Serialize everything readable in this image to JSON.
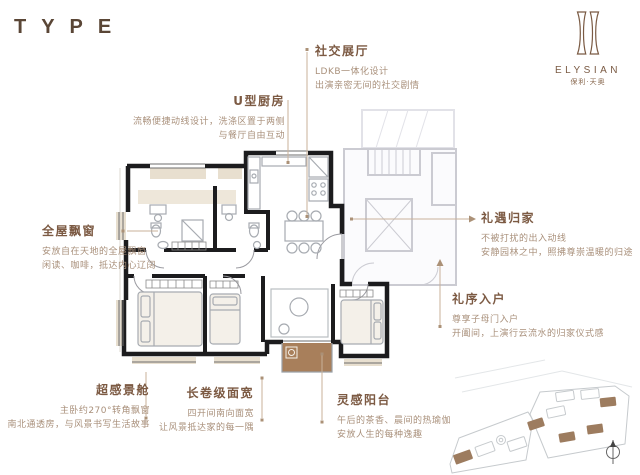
{
  "header": {
    "type_label": "TYPE"
  },
  "brand": {
    "name": "ELYSIAN",
    "cn_name": "保利·天奥"
  },
  "annotations": {
    "social_hall": {
      "title": "社交展厅",
      "lines": [
        "LDKB一体化设计",
        "出演亲密无间的社交剧情"
      ]
    },
    "u_kitchen": {
      "title": "U型厨房",
      "lines": [
        "流畅便捷动线设计，洗涤区置于两侧",
        "与餐厅自由互动"
      ]
    },
    "bay_windows": {
      "title": "全屋飘窗",
      "lines": [
        "安放自在天地的全屋飘窗",
        "闲读、咖啡，抵达内心辽阔"
      ]
    },
    "homecoming": {
      "title": "礼遇归家",
      "lines": [
        "不被打扰的出入动线",
        "安静园林之中，照拂尊崇温暖的归途"
      ]
    },
    "entry": {
      "title": "礼序入户",
      "lines": [
        "尊享子母门入户",
        "开阖间，上演行云流水的归家仪式感"
      ]
    },
    "sense_cabin": {
      "title": "超感景舱",
      "lines": [
        "主卧约270°转角飘窗",
        "南北通透房，与风景书写生活故事"
      ]
    },
    "wide_frontage": {
      "title": "长卷级面宽",
      "lines": [
        "四开间南向面宽",
        "让风景抵达家的每一隅"
      ]
    },
    "balcony": {
      "title": "灵感阳台",
      "lines": [
        "午后的茶香、晨间的热瑜伽",
        "安放人生的每种逸趣"
      ]
    }
  },
  "colors": {
    "title_brown": "#7c5a43",
    "desc_brown": "#a9907b",
    "wall_black": "#1c1c1e",
    "leader_tan": "#c9b29a",
    "balcony_brown": "#a87f5b",
    "core_gray": "#cbcbd2",
    "bay_beige": "#e8dfcf"
  }
}
